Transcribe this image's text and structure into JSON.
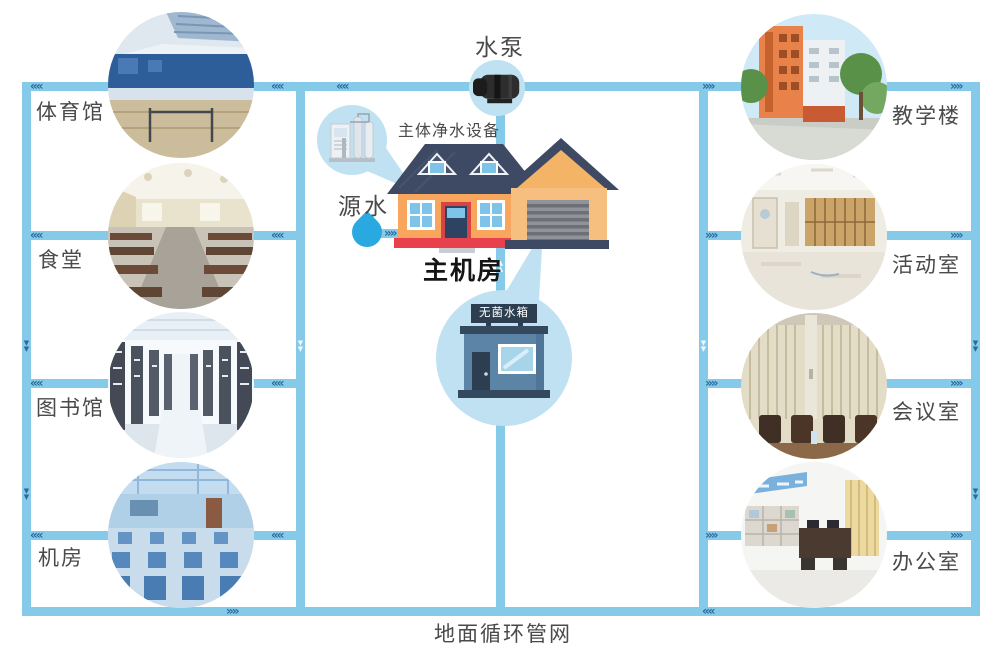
{
  "diagram": {
    "pump_label": "水泵",
    "purifier_label": "主体净水设备",
    "source_label": "源水",
    "main_room_label": "主机房",
    "tank_label": "无菌水箱",
    "bottom_label": "地面循环管网",
    "left_facilities": [
      {
        "label": "体育馆",
        "photo": "gymnasium-interior"
      },
      {
        "label": "食堂",
        "photo": "dining-hall-interior"
      },
      {
        "label": "图书馆",
        "photo": "library-shelves"
      },
      {
        "label": "机房",
        "photo": "computer-lab"
      }
    ],
    "right_facilities": [
      {
        "label": "教学楼",
        "photo": "teaching-building-exterior"
      },
      {
        "label": "活动室",
        "photo": "activity-room-interior"
      },
      {
        "label": "会议室",
        "photo": "meeting-room-interior"
      },
      {
        "label": "办公室",
        "photo": "office-interior"
      }
    ],
    "flow_arrows": {
      "left": "««",
      "right": "»»",
      "down": "▼\n▼",
      "up": "▲\n▲"
    },
    "icons": {
      "pump": "water-pump-icon",
      "purifier": "water-purifier-icon",
      "source": "water-drop-icon",
      "main_room": "house-icon",
      "tank": "tank-building-icon"
    },
    "colors": {
      "pipe": "#85cbe9",
      "arrow": "#2a6a9e",
      "bubble": "#bfe1f1",
      "house_wall": "#f8a55e",
      "garage_wall": "#f6bf80",
      "roof": "#3e4a63",
      "base_red": "#e8414d",
      "tank_body": "#5b84a6",
      "tank_dark": "#2c3e50",
      "water_drop": "#29a9e0",
      "label_text": "#4a4a4a"
    }
  }
}
